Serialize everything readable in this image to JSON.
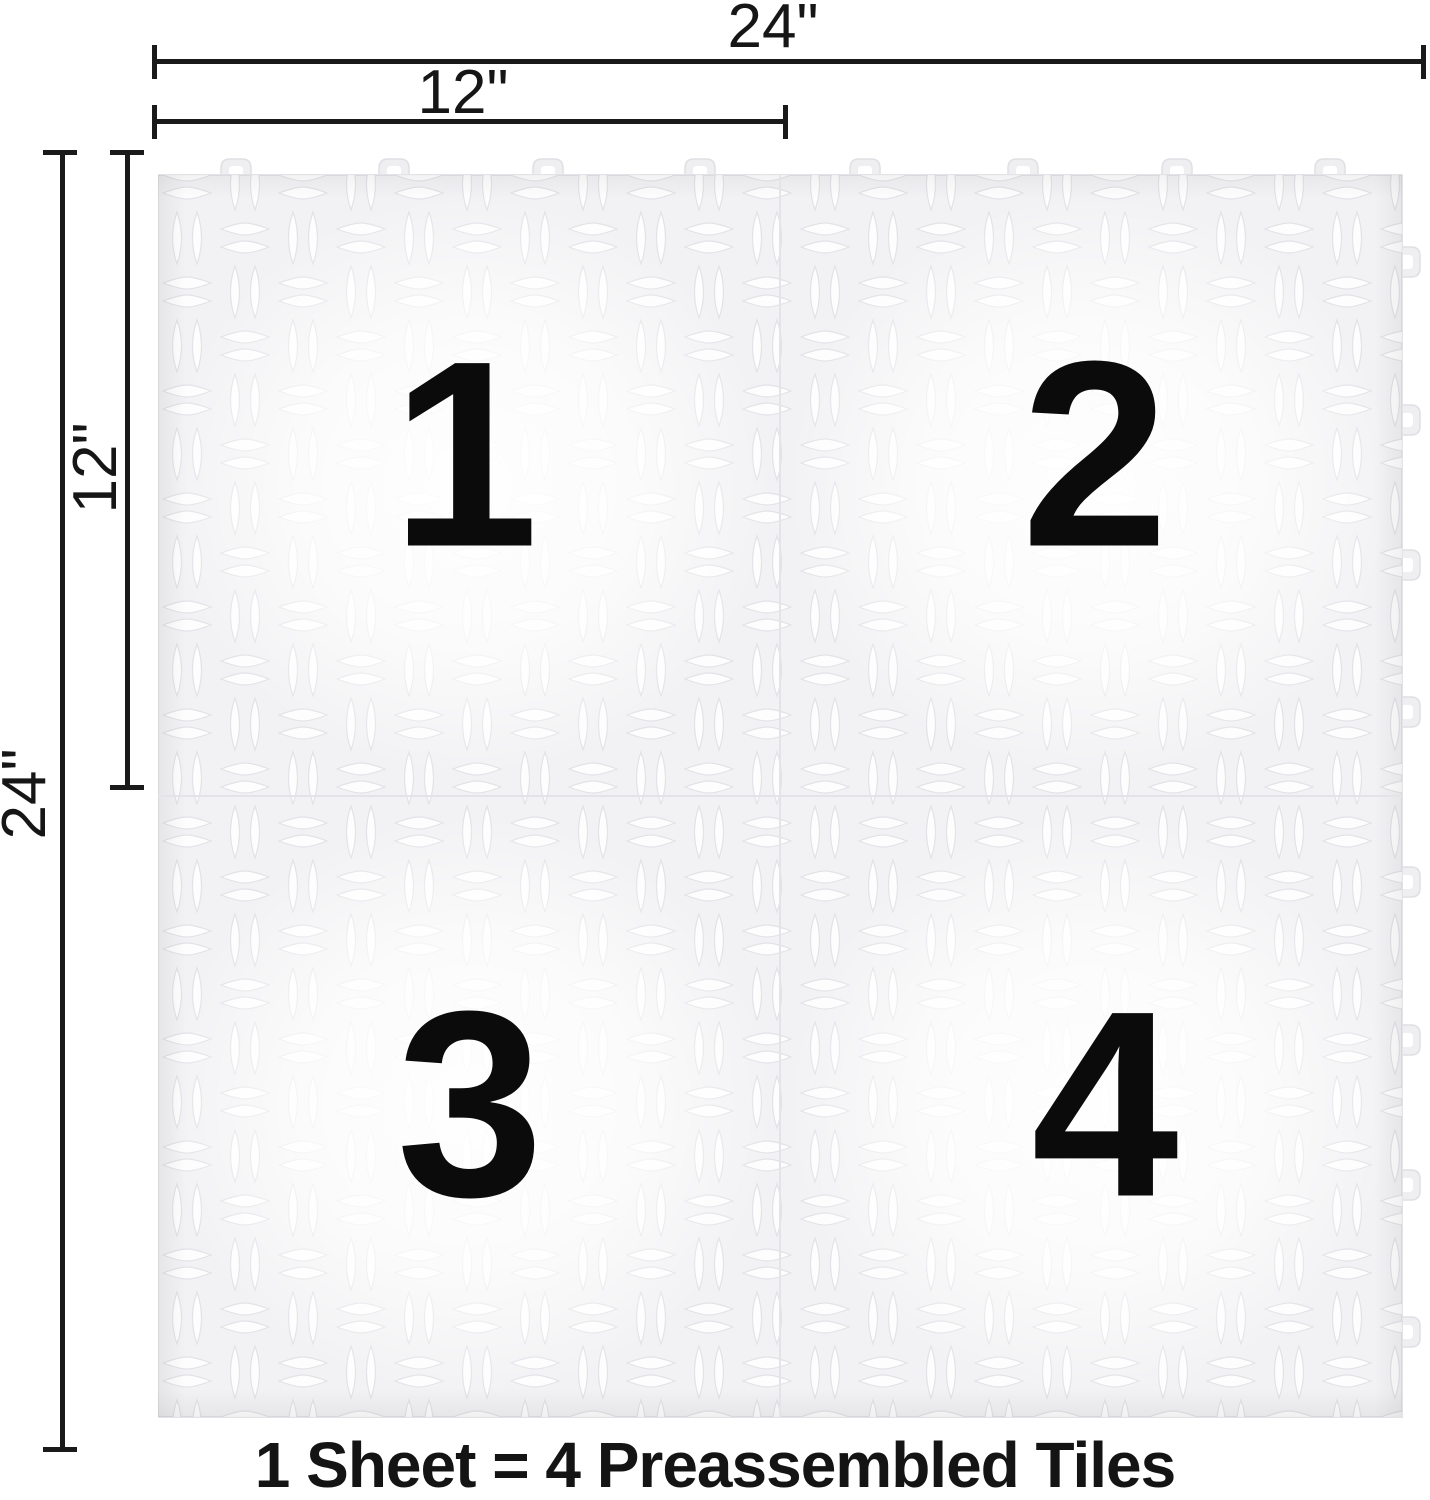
{
  "dimensions": {
    "top_full": "24\"",
    "top_half": "12\"",
    "left_full": "24\"",
    "left_half": "12\""
  },
  "tiles": [
    {
      "label": "1"
    },
    {
      "label": "2"
    },
    {
      "label": "3"
    },
    {
      "label": "4"
    }
  ],
  "caption": "1 Sheet = 4 Preassembled Tiles",
  "colors": {
    "dimension_line": "#1a1a1a",
    "number_text": "#0b0b0b",
    "caption_text": "#141414",
    "tile_base": "#f2f2f4",
    "tile_highlight": "#ffffff",
    "texture_line": "#e2e2e7",
    "seam": "#e4e4e8"
  }
}
